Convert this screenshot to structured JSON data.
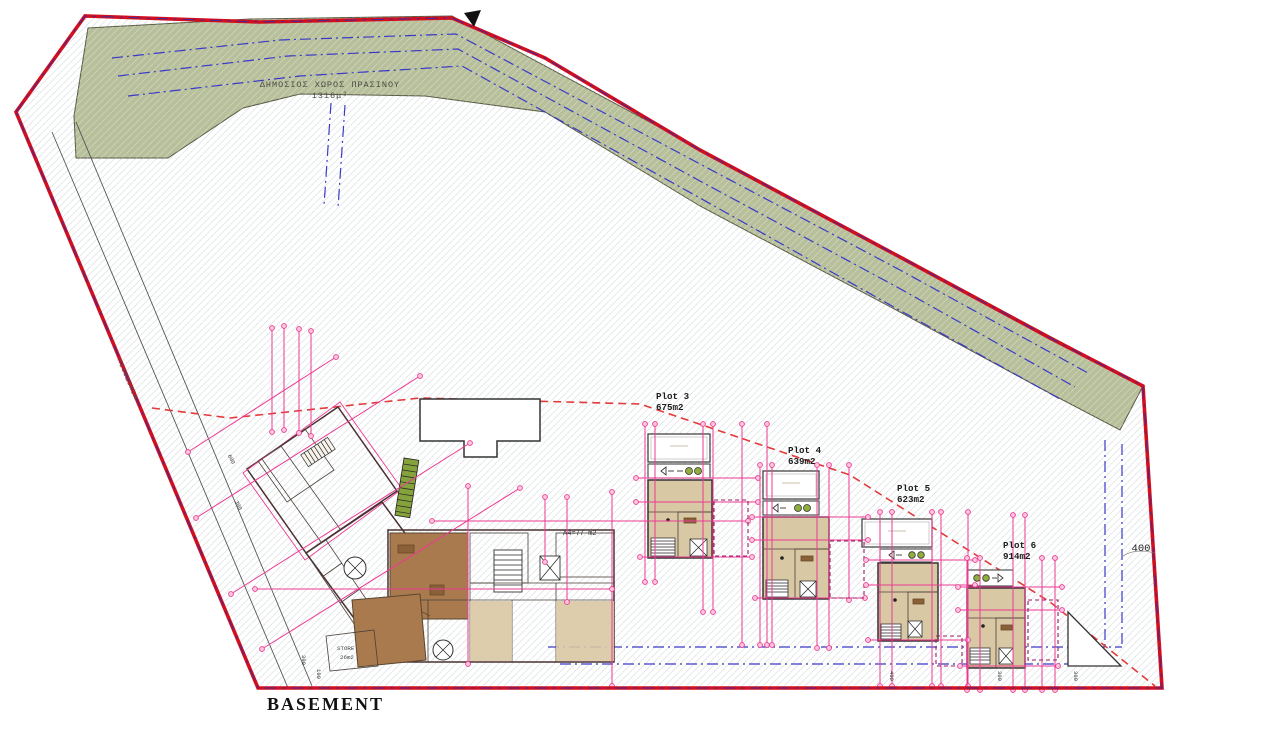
{
  "drawing": {
    "title": "BASEMENT"
  },
  "green_space": {
    "label": "ΔΗΜΟΣΙΟΣ ΧΩΡΟΣ ΠΡΑΣΙΝΟΥ",
    "area": "1316μ²"
  },
  "plots": [
    {
      "name": "Plot 3",
      "area": "675m2"
    },
    {
      "name": "Plot 4",
      "area": "639m2"
    },
    {
      "name": "Plot 5",
      "area": "623m2"
    },
    {
      "name": "Plot 6",
      "area": "914m2"
    }
  ],
  "rooms": {
    "unit_a4": "A4=77 m2",
    "store": "STORE",
    "store_area": "26m2"
  },
  "road_label": "ΛΙΘΟΔΟΜΙΑ",
  "dimensions": {
    "right_setback": "400",
    "ticks": [
      "600",
      "300",
      "300",
      "100",
      "400",
      "300",
      "300"
    ]
  },
  "icons": {
    "north_arrow": "filled-black-triangle",
    "car": "car-plan-symbol"
  },
  "colors": {
    "boundary_red": "#d10f1e",
    "setback_blue": "#3a3ac8",
    "dimension_magenta": "#ec3a93",
    "guide_red_dashed": "#e23b3b",
    "green_space": "#b7bf9b",
    "floor_tan": "#d9c8a4",
    "floor_wood": "#a87a4e"
  }
}
